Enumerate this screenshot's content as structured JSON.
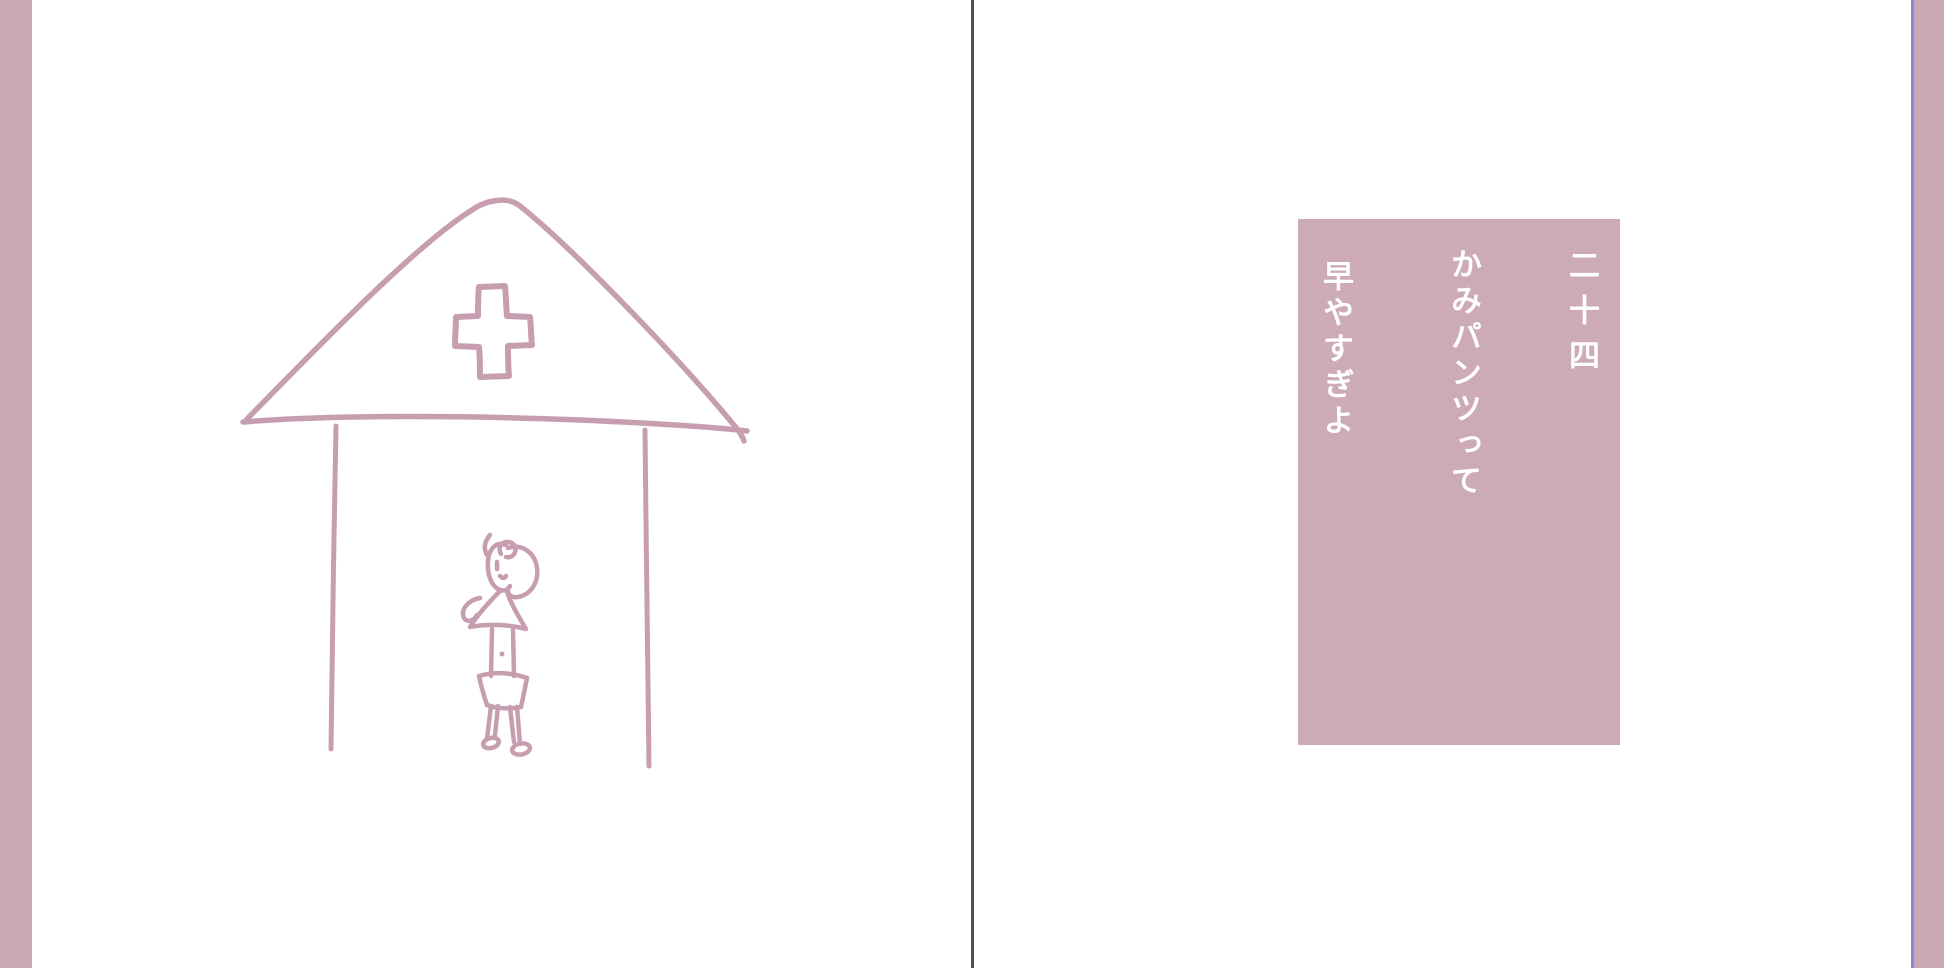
{
  "reader": {
    "page_background": "#ffffff",
    "gutter_divider_color": "#4f4f4f",
    "edge_strip_color": "#c9a8b4",
    "next_page_edge_highlight_color": "#7d8cd7"
  },
  "left_page": {
    "illustration_stroke_color": "#c69eb0"
  },
  "right_page": {
    "verse_box_color": "#ccaab7",
    "verse_text_color": "#ffffff",
    "chapter_number": "二十四",
    "verse_line_1": "かみパンツって",
    "verse_line_2": "早やすぎよ"
  }
}
